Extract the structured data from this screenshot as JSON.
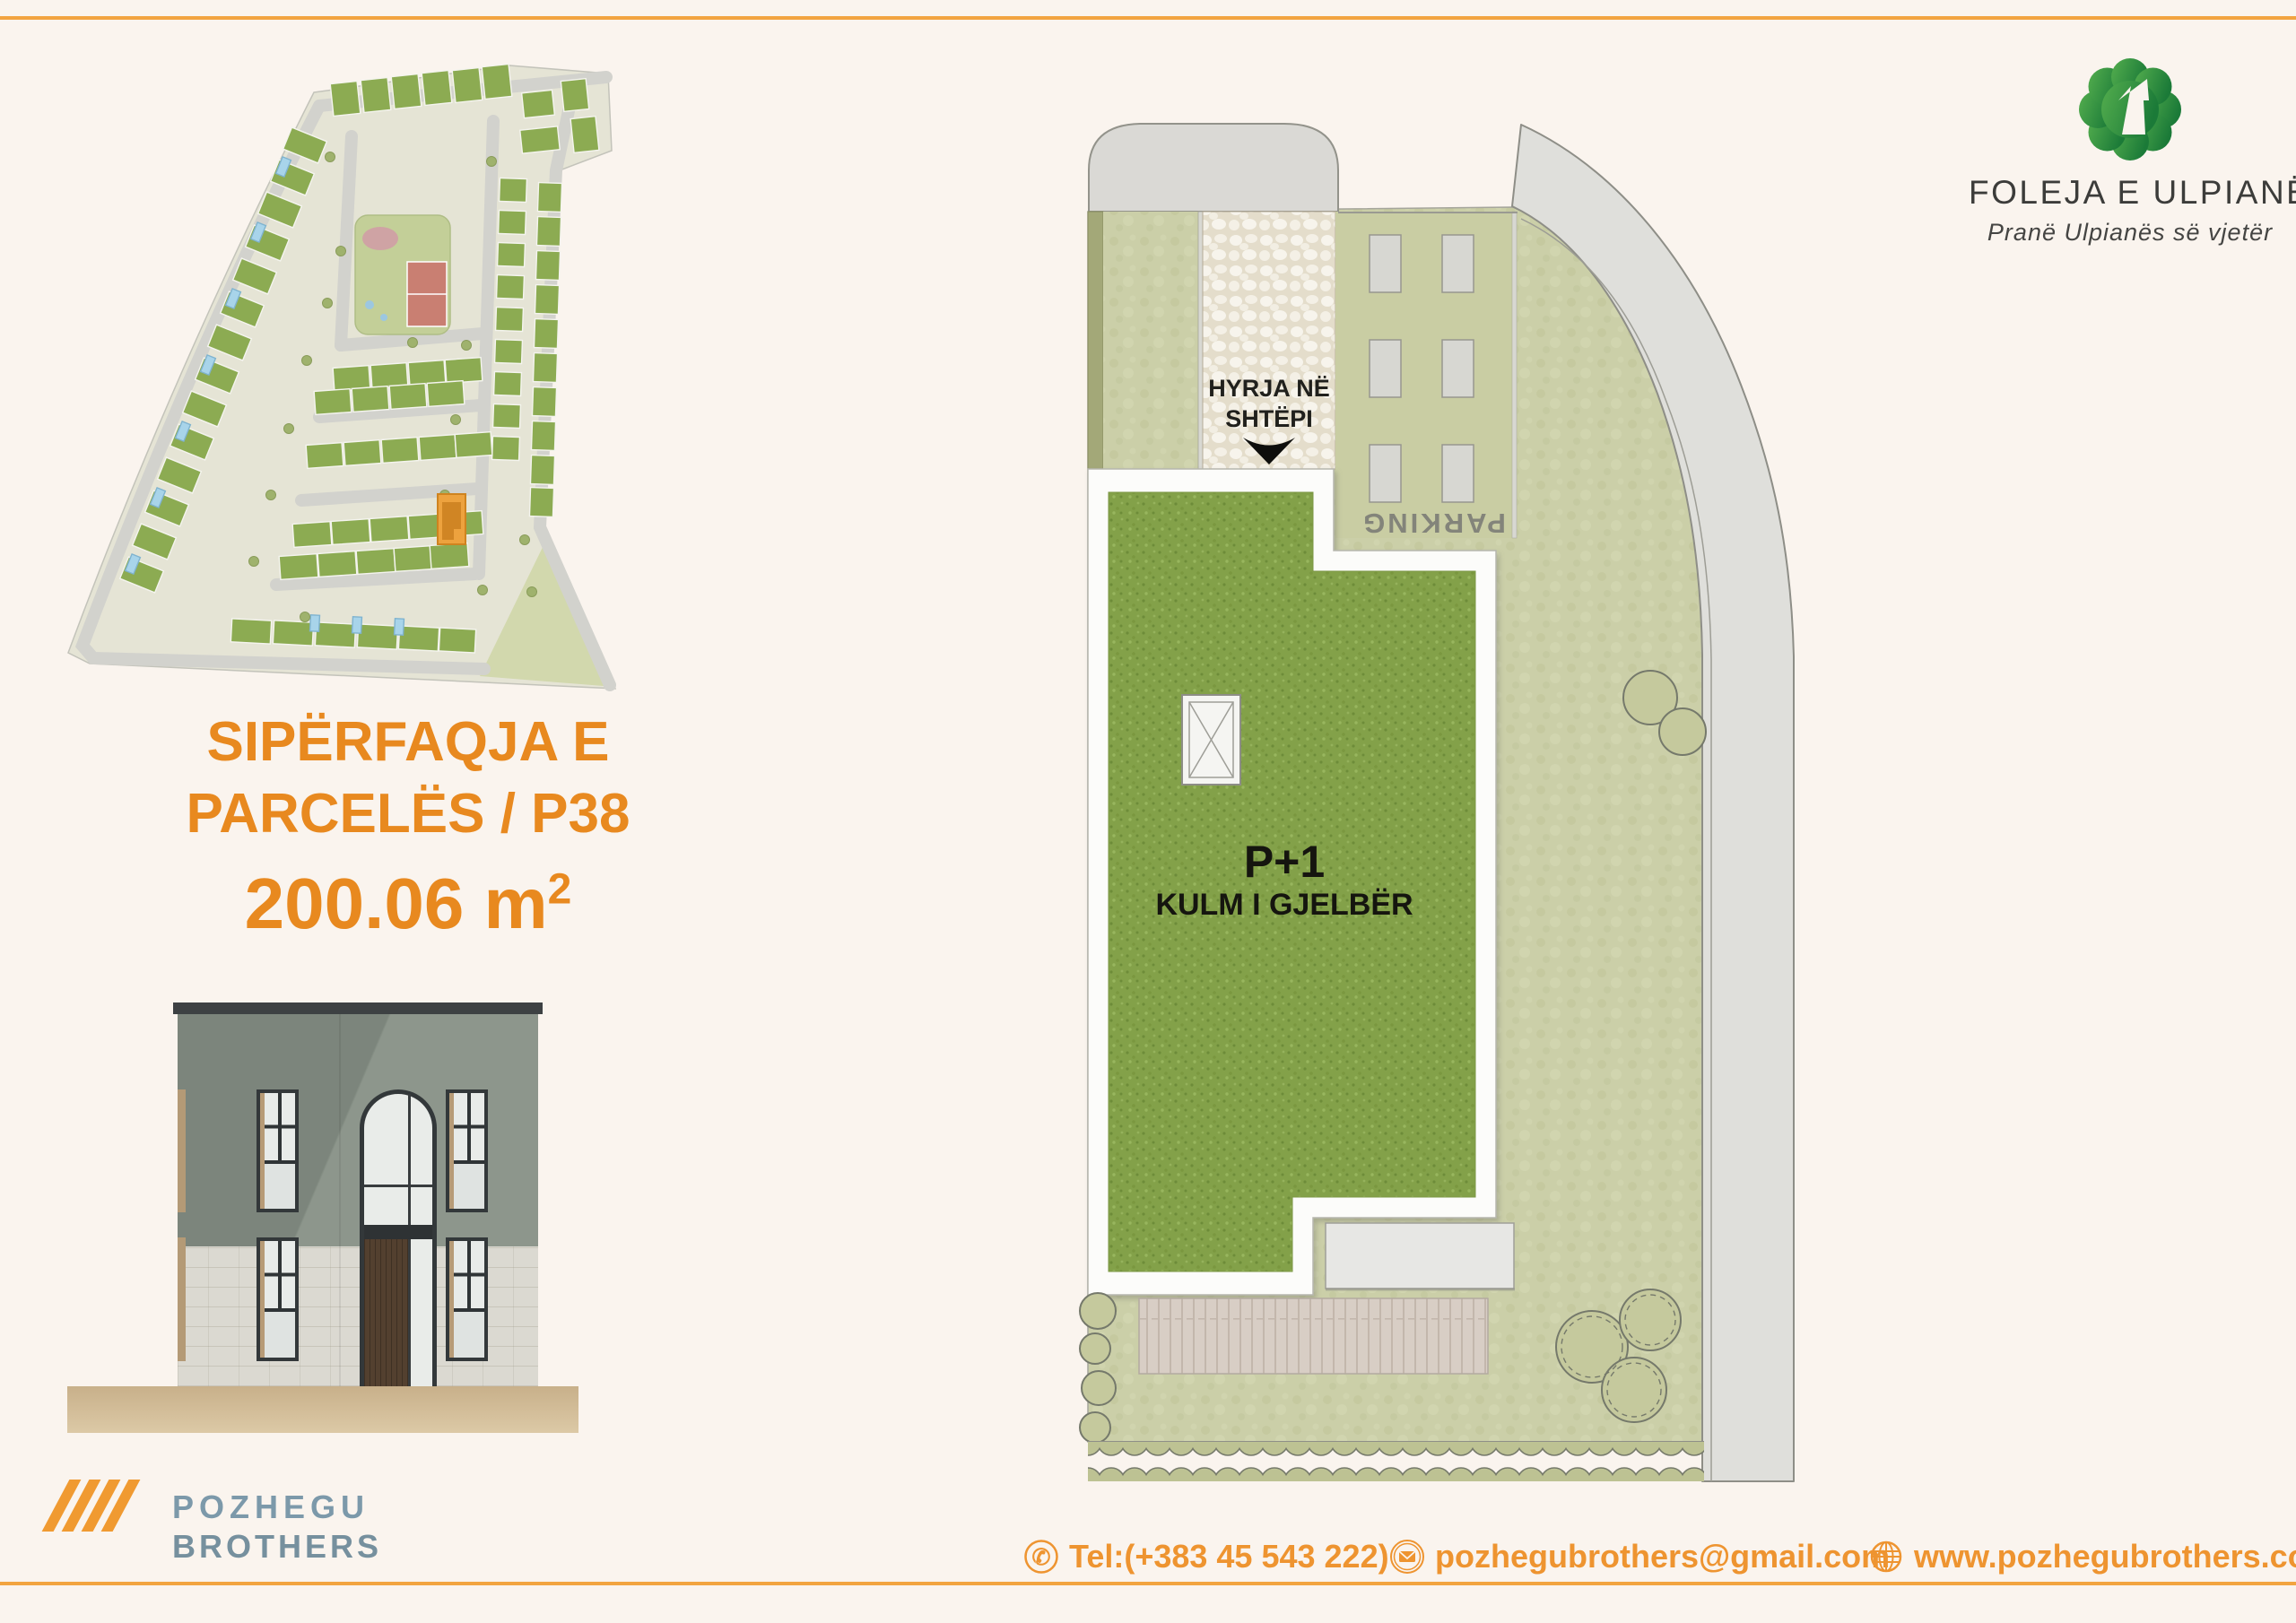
{
  "colors": {
    "page_background": "#FAF4EE",
    "accent_orange": "#E8891F",
    "footer_orange": "#EE9430",
    "brand_green_light": "#54AE4E",
    "brand_green_dark": "#1B7A38",
    "developer_blue": "#7C99AA"
  },
  "brand": {
    "name": "FOLEJA E ULPIANËS",
    "tagline": "Pranë Ulpianës së vjetër"
  },
  "parcel": {
    "title_line1": "SIPËRFAQJA E",
    "title_line2": "PARCELËS / P38",
    "area_value": "200.06 m",
    "area_superscript": "2"
  },
  "plan": {
    "entrance_line1": "HYRJA NË",
    "entrance_line2": "SHTËPI",
    "parking_label": "PARKING",
    "roof_label": "P+1",
    "roof_sublabel": "KULM I GJELBËR"
  },
  "developer": {
    "name_line1": "POZHEGU",
    "name_line2": "BROTHERS"
  },
  "footer": {
    "phone": "Tel:(+383 45 543 222)",
    "email": "pozhegubrothers@gmail.com",
    "website": "www.pozhegubrothers.com"
  }
}
